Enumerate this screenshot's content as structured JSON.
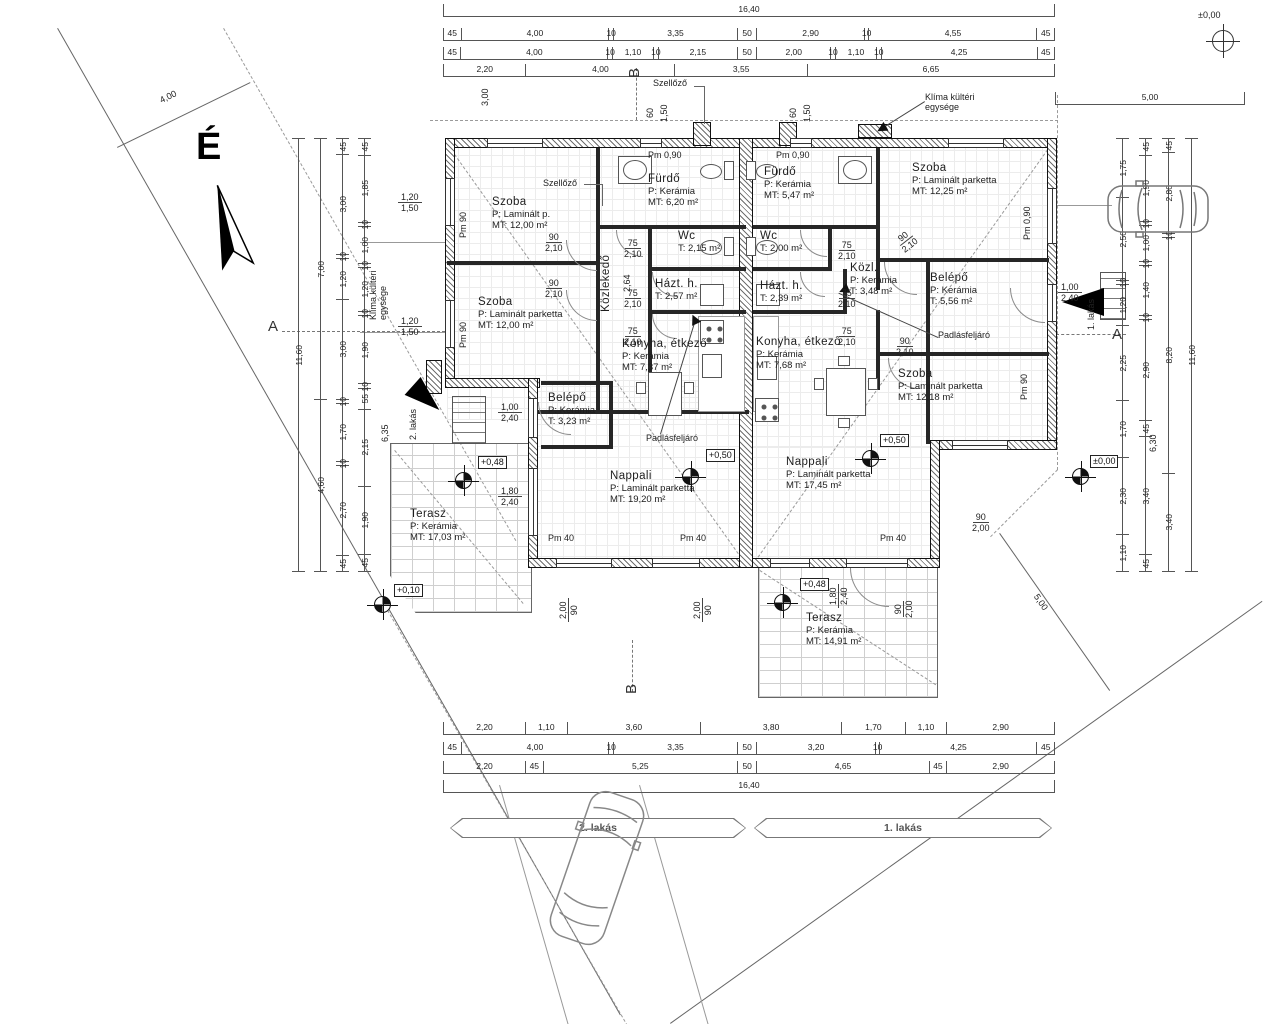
{
  "compass": {
    "label": "É"
  },
  "site": {
    "banners": [
      {
        "label": "2. lakás",
        "x": 450,
        "y": 818,
        "w": 296
      },
      {
        "label": "1. lakás",
        "x": 754,
        "y": 818,
        "w": 298
      }
    ]
  },
  "dims": {
    "top_rows": [
      [
        "16,40"
      ],
      [
        "45",
        "4,00",
        "10",
        "3,35",
        "50",
        "2,90",
        "10",
        "4,55",
        "45"
      ],
      [
        "45",
        "4,00",
        "10",
        "1,10",
        "10",
        "2,15",
        "50",
        "2,00",
        "10",
        "1,10",
        "10",
        "4,25",
        "45"
      ],
      [
        "2,20",
        "4,00",
        "3,55",
        "6,65"
      ]
    ],
    "bottom_rows": [
      [
        "2,20",
        "1,10",
        "3,60",
        "3,80",
        "1,70",
        "1,10",
        "2,90"
      ],
      [
        "45",
        "4,00",
        "10",
        "3,35",
        "50",
        "3,20",
        "10",
        "4,25",
        "45"
      ],
      [
        "2,20",
        "45",
        "5,25",
        "50",
        "4,65",
        "45",
        "2,90"
      ],
      [
        "16,40"
      ]
    ],
    "left_cols": [
      [
        "11,60"
      ],
      [
        "7,00",
        "4,60"
      ],
      [
        "45",
        "3,00",
        "10",
        "1,20",
        "3,00",
        "10",
        "1,70",
        "10",
        "2,70",
        "45"
      ],
      [
        "45",
        "1,85",
        "10",
        "1,00",
        "10",
        "1,20",
        "10",
        "1,90",
        "10",
        "55",
        "2,15",
        "1,90",
        "45"
      ]
    ],
    "right_cols": [
      [
        "1,75",
        "2,50",
        "10",
        "1,20",
        "2,25",
        "1,70",
        "2,30",
        "1,10"
      ],
      [
        "45",
        "1,90",
        "10",
        "1,00",
        "10",
        "1,40",
        "10",
        "2,90",
        "45",
        "3,40",
        "45"
      ],
      [
        "45",
        "2,80",
        "10",
        "8,20",
        "3,40"
      ],
      [
        "11,60"
      ]
    ],
    "top_right": [
      "5,00"
    ]
  },
  "rooms": [
    {
      "name": "Szoba",
      "l1": "P: Laminált p.",
      "l2": "MT: 12,00 m²",
      "x": 492,
      "y": 196
    },
    {
      "name": "Szoba",
      "l1": "P: Laminált parketta",
      "l2": "MT: 12,00 m²",
      "x": 478,
      "y": 296
    },
    {
      "name": "Fürdő",
      "l1": "P: Kerámia",
      "l2": "MT: 6,20 m²",
      "x": 648,
      "y": 173
    },
    {
      "name": "Wc",
      "l1": "T: 2,15 m²",
      "x": 678,
      "y": 230
    },
    {
      "name": "Házt. h.",
      "l1": "T: 2,57 m²",
      "x": 655,
      "y": 278
    },
    {
      "name": "Közlekedő",
      "x": 600,
      "y": 312,
      "rot": -90
    },
    {
      "name": "Konyha, étkező",
      "l1": "P: Kerámia",
      "l2": "MT: 7,37 m²",
      "x": 622,
      "y": 338
    },
    {
      "name": "Belépő",
      "l1": "P: Kerámia",
      "l2": "T: 3,23 m²",
      "x": 548,
      "y": 392
    },
    {
      "name": "Nappali",
      "l1": "P: Laminált parketta",
      "l2": "MT: 19,20 m²",
      "x": 610,
      "y": 470
    },
    {
      "name": "Terasz",
      "l1": "P: Kerámia",
      "l2": "MT: 17,03 m²",
      "x": 410,
      "y": 508
    },
    {
      "name": "Fürdő",
      "l1": "P: Kerámia",
      "l2": "MT: 5,47 m²",
      "x": 764,
      "y": 166
    },
    {
      "name": "Wc",
      "l1": "T: 2,00 m²",
      "x": 760,
      "y": 230
    },
    {
      "name": "Házt. h.",
      "l1": "T: 2,39 m²",
      "x": 760,
      "y": 280
    },
    {
      "name": "Szoba",
      "l1": "P: Laminált parketta",
      "l2": "MT: 12,25 m²",
      "x": 912,
      "y": 162
    },
    {
      "name": "Közl.",
      "l1": "P: Kerámia",
      "l2": "T: 3,48 m²",
      "x": 850,
      "y": 262
    },
    {
      "name": "Belépő",
      "l1": "P: Kerámia",
      "l2": "T: 5,56 m²",
      "x": 930,
      "y": 272
    },
    {
      "name": "Konyha, étkező",
      "l1": "P: Kerámia",
      "l2": "MT: 7,68 m²",
      "x": 756,
      "y": 336
    },
    {
      "name": "Szoba",
      "l1": "P: Laminált parketta",
      "l2": "MT: 12,18 m²",
      "x": 898,
      "y": 368
    },
    {
      "name": "Nappali",
      "l1": "P: Laminált parketta",
      "l2": "MT: 17,45 m²",
      "x": 786,
      "y": 456
    },
    {
      "name": "Terasz",
      "l1": "P: Kerámia",
      "l2": "MT: 14,91 m²",
      "x": 806,
      "y": 612
    }
  ],
  "annotations": [
    {
      "t": "É",
      "x": 196,
      "y": 126,
      "cls": "north"
    },
    {
      "t": "4,00",
      "x": 158,
      "y": 96,
      "rot": -26
    },
    {
      "t": "±0,00",
      "x": 1198,
      "y": 10
    },
    {
      "t": "Szellőző",
      "x": 653,
      "y": 78
    },
    {
      "t": "Szellőző",
      "x": 543,
      "y": 178
    },
    {
      "t": "Klíma kültéri\negysége",
      "x": 925,
      "y": 92,
      "cls": "wrap",
      "w": 80
    },
    {
      "t": "Klíma kültéri\negysége",
      "x": 368,
      "y": 320,
      "rot": -90,
      "cls": "wrap",
      "w": 70
    },
    {
      "t": "Padlásfeljáró",
      "x": 646,
      "y": 433
    },
    {
      "t": "Padlásfeljáró",
      "x": 938,
      "y": 330
    },
    {
      "t": "B",
      "x": 626,
      "y": 78,
      "rot": -90,
      "cls": "sec"
    },
    {
      "t": "B",
      "x": 623,
      "y": 694,
      "rot": -90,
      "cls": "sec"
    },
    {
      "t": "A",
      "x": 268,
      "y": 318,
      "cls": "sec"
    },
    {
      "t": "A",
      "x": 1112,
      "y": 326,
      "cls": "sec"
    },
    {
      "t": "2. lakás",
      "x": 408,
      "y": 440,
      "rot": -90
    },
    {
      "t": "1. lakás",
      "x": 1086,
      "y": 330,
      "rot": -90
    },
    {
      "t": "Pm 0,90",
      "x": 648,
      "y": 150
    },
    {
      "t": "Pm 0,90",
      "x": 776,
      "y": 150
    },
    {
      "t": "Pm 0,90",
      "x": 1022,
      "y": 240,
      "rot": -90
    },
    {
      "t": "Pm 90",
      "x": 458,
      "y": 238,
      "rot": -90
    },
    {
      "t": "Pm 90",
      "x": 458,
      "y": 348,
      "rot": -90
    },
    {
      "t": "Pm 90",
      "x": 1019,
      "y": 400,
      "rot": -90
    },
    {
      "t": "Pm 40",
      "x": 548,
      "y": 533
    },
    {
      "t": "Pm 40",
      "x": 680,
      "y": 533
    },
    {
      "t": "Pm 40",
      "x": 880,
      "y": 533
    },
    {
      "t": "2,64",
      "x": 622,
      "y": 292,
      "rot": -90
    },
    {
      "t": "3,00",
      "x": 480,
      "y": 106,
      "rot": -90
    },
    {
      "t": "60",
      "x": 645,
      "y": 118,
      "rot": -90
    },
    {
      "t": "1,50",
      "x": 659,
      "y": 122,
      "rot": -90
    },
    {
      "t": "60",
      "x": 788,
      "y": 118,
      "rot": -90
    },
    {
      "t": "1,50",
      "x": 802,
      "y": 122,
      "rot": -90
    },
    {
      "t": "5,00",
      "x": 1040,
      "y": 592,
      "rot": 55
    },
    {
      "t": "6,35",
      "x": 380,
      "y": 442,
      "rot": -90
    },
    {
      "t": "6,30",
      "x": 1148,
      "y": 452,
      "rot": -90
    }
  ],
  "door_dims": [
    {
      "a": "1,20",
      "b": "1,50",
      "x": 398,
      "y": 192
    },
    {
      "a": "1,20",
      "b": "1,50",
      "x": 398,
      "y": 316
    },
    {
      "a": "90",
      "b": "2,10",
      "x": 545,
      "y": 232
    },
    {
      "a": "90",
      "b": "2,10",
      "x": 545,
      "y": 278
    },
    {
      "a": "75",
      "b": "2,10",
      "x": 624,
      "y": 238
    },
    {
      "a": "75",
      "b": "2,10",
      "x": 624,
      "y": 288
    },
    {
      "a": "75",
      "b": "2,10",
      "x": 624,
      "y": 326
    },
    {
      "a": "75",
      "b": "2,10",
      "x": 838,
      "y": 240
    },
    {
      "a": "75",
      "b": "2,10",
      "x": 838,
      "y": 288
    },
    {
      "a": "75",
      "b": "2,10",
      "x": 838,
      "y": 326
    },
    {
      "a": "90",
      "b": "2,10",
      "x": 893,
      "y": 238,
      "rot": -38
    },
    {
      "a": "90",
      "b": "2,10",
      "x": 896,
      "y": 336
    },
    {
      "a": "1,00",
      "b": "2,40",
      "x": 498,
      "y": 402
    },
    {
      "a": "1,80",
      "b": "2,40",
      "x": 498,
      "y": 486
    },
    {
      "a": "1,00",
      "b": "2,40",
      "x": 1058,
      "y": 282
    },
    {
      "a": "1,80",
      "b": "2,40",
      "x": 828,
      "y": 608,
      "rot": -90
    },
    {
      "a": "90",
      "b": "2,00",
      "x": 893,
      "y": 618,
      "rot": -90
    },
    {
      "a": "90",
      "b": "2,00",
      "x": 972,
      "y": 512
    },
    {
      "a": "2,00",
      "b": "90",
      "x": 558,
      "y": 622,
      "rot": -90
    },
    {
      "a": "2,00",
      "b": "90",
      "x": 692,
      "y": 622,
      "rot": -90
    }
  ],
  "levels": [
    {
      "t": "+0,48",
      "x": 478,
      "y": 456
    },
    {
      "t": "+0,50",
      "x": 706,
      "y": 449
    },
    {
      "t": "+0,50",
      "x": 880,
      "y": 434
    },
    {
      "t": "+0,48",
      "x": 800,
      "y": 578
    },
    {
      "t": "+0,10",
      "x": 394,
      "y": 584
    },
    {
      "t": "±0,00",
      "x": 1090,
      "y": 455
    }
  ],
  "markers": [
    {
      "x": 455,
      "y": 472
    },
    {
      "x": 682,
      "y": 468
    },
    {
      "x": 862,
      "y": 450
    },
    {
      "x": 1072,
      "y": 468
    },
    {
      "x": 374,
      "y": 596
    },
    {
      "x": 774,
      "y": 594
    }
  ]
}
